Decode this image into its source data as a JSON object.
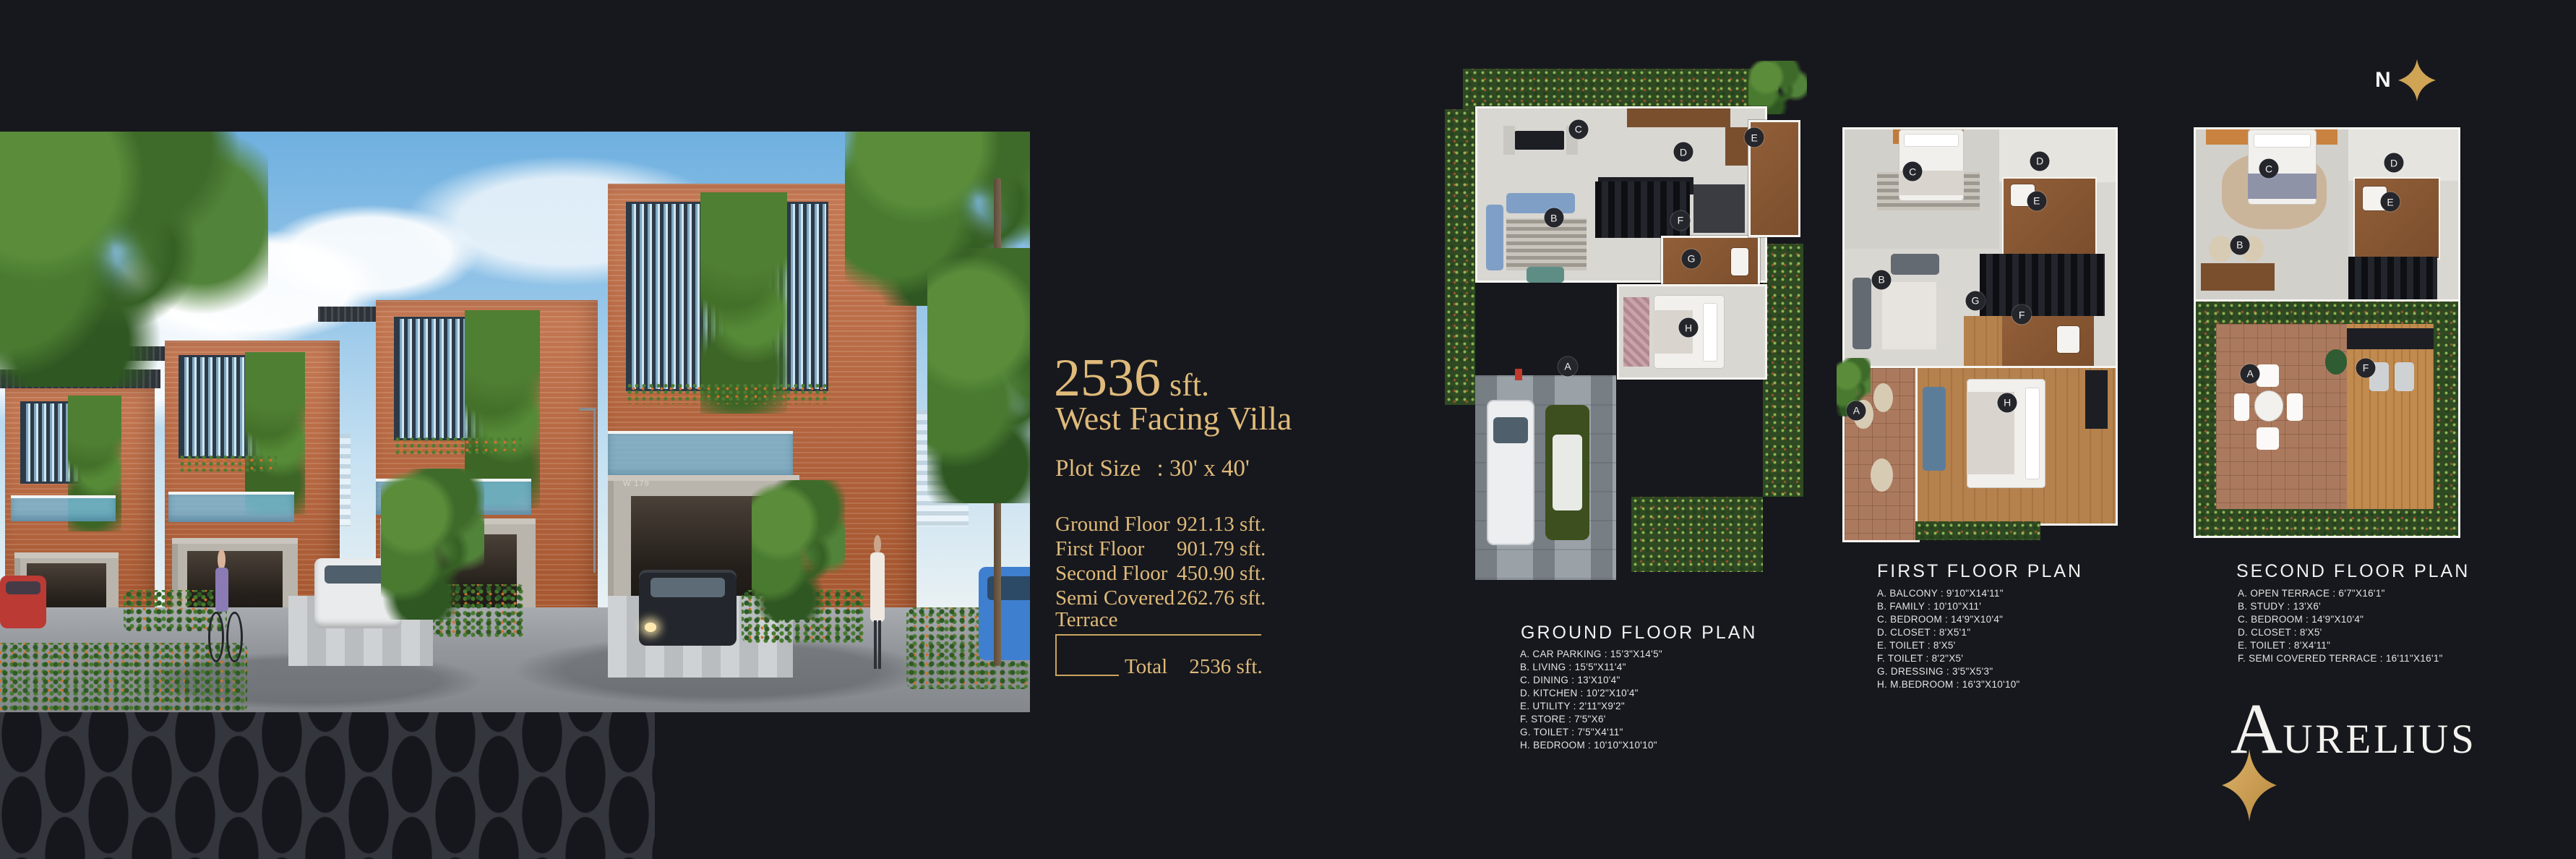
{
  "page": {
    "background": "#17181d",
    "accent_gold": "#dfba7a"
  },
  "north": {
    "label": "N"
  },
  "hero": {
    "villa_number": "W 179"
  },
  "summary": {
    "area": "2536",
    "area_unit": "sft.",
    "facing": "West Facing Villa",
    "plot_label": "Plot Size",
    "plot_value": ": 30' x 40'",
    "floors": [
      {
        "label": "Ground Floor",
        "value": "921.13 sft."
      },
      {
        "label": "First Floor",
        "value": "901.79 sft."
      },
      {
        "label": "Second Floor",
        "value": "450.90 sft."
      },
      {
        "label": "Semi Covered Terrace",
        "value": "262.76 sft."
      }
    ],
    "total_label": "Total",
    "total_value": "2536 sft."
  },
  "plans": {
    "ground": {
      "title": "GROUND FLOOR PLAN",
      "legend": [
        "A. CAR PARKING : 15'3\"X14'5\"",
        "B. LIVING : 15'5\"X11'4\"",
        "C. DINING : 13'X10'4\"",
        "D. KITCHEN : 10'2\"X10'4\"",
        "E. UTILITY : 2'11\"X9'2\"",
        "F. STORE : 7'5\"X6'",
        "G. TOILET : 7'5\"X4'11\"",
        "H. BEDROOM : 10'10\"X10'10\""
      ],
      "badges": [
        "A",
        "B",
        "C",
        "D",
        "E",
        "F",
        "G",
        "H"
      ]
    },
    "first": {
      "title": "FIRST FLOOR PLAN",
      "legend": [
        "A. BALCONY : 9'10\"X14'11\"",
        "B. FAMILY : 10'10\"X11'",
        "C. BEDROOM : 14'9\"X10'4\"",
        "D. CLOSET : 8'X5'1\"",
        "E. TOILET : 8'X5'",
        "F. TOILET : 8'2\"X5'",
        "G. DRESSING : 3'5\"X5'3\"",
        "H. M.BEDROOM : 16'3\"X10'10\""
      ],
      "badges": [
        "A",
        "B",
        "C",
        "D",
        "E",
        "F",
        "G",
        "H"
      ]
    },
    "second": {
      "title": "SECOND FLOOR PLAN",
      "legend": [
        "A. OPEN TERRACE : 6'7\"X16'1\"",
        "B. STUDY : 13'X6'",
        "C. BEDROOM : 14'9\"X10'4\"",
        "D. CLOSET : 8'X5'",
        "E. TOILET : 8'X4'11\"",
        "F. SEMI COVERED TERRACE : 16'11\"X16'1\""
      ],
      "badges": [
        "A",
        "B",
        "C",
        "D",
        "E",
        "F"
      ]
    }
  },
  "brand": {
    "initial": "A",
    "rest": "URELIUS"
  }
}
